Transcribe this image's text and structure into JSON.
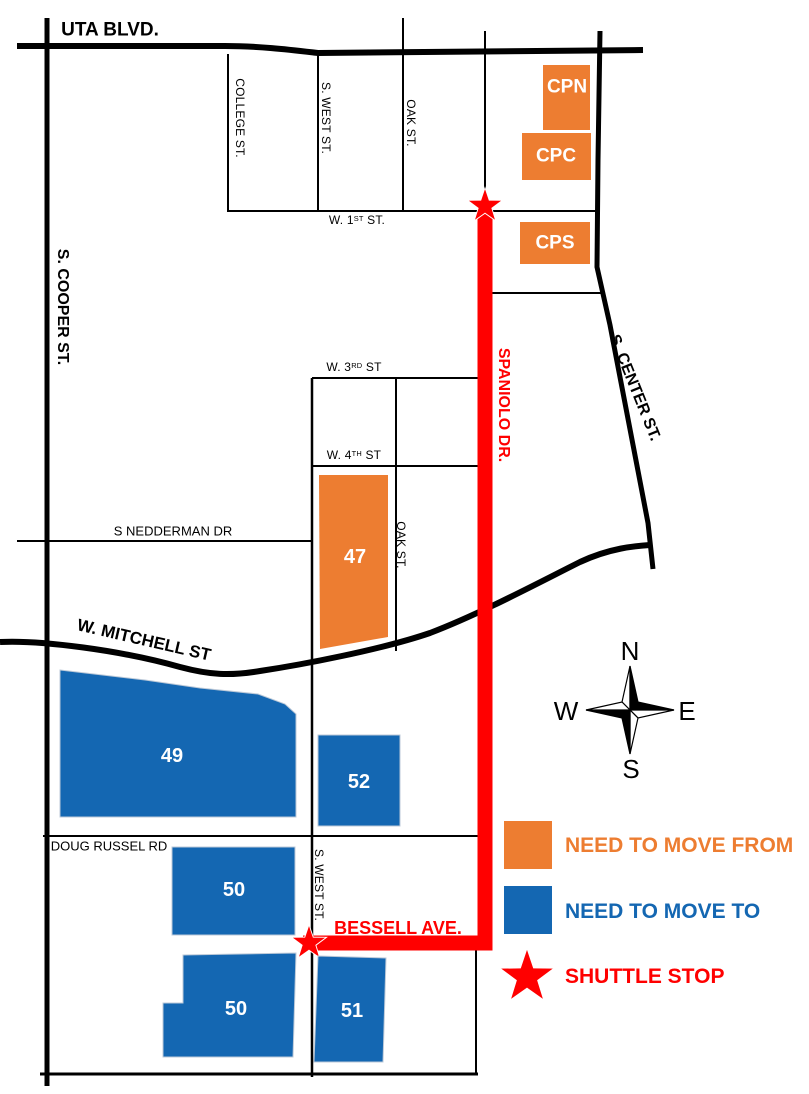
{
  "colors": {
    "orange": "#ED7D31",
    "blue": "#1467B2",
    "red": "#FF0000"
  },
  "streets": {
    "uta": "UTA BLVD.",
    "cooper": "S. COOPER ST.",
    "college": "COLLEGE ST.",
    "west": "S. WEST ST.",
    "oak": "OAK ST.",
    "center": "S. CENTER ST.",
    "w_1st": {
      "base": "W. 1",
      "sup": "ST",
      "rest": " ST."
    },
    "w_3rd": {
      "base": "W. 3",
      "sup": "RD",
      "rest": " ST"
    },
    "w_4th": {
      "base": "W. 4",
      "sup": "TH",
      "rest": " ST"
    },
    "nedderman": "S NEDDERMAN DR",
    "mitchell": "W. MITCHELL ST",
    "doug_russel": "DOUG RUSSEL RD",
    "spaniolo": "SPANIOLO DR.",
    "bessell": "BESSELL AVE."
  },
  "buildings": {
    "cpn": "CPN",
    "cpc": "CPC",
    "cps": "CPS",
    "b47": "47",
    "b49": "49",
    "b52": "52",
    "b50_upper": "50",
    "b50_lower": "50",
    "b51": "51"
  },
  "compass": {
    "n": "N",
    "e": "E",
    "s": "S",
    "w": "W"
  },
  "legend": {
    "move_from": "NEED TO MOVE FROM",
    "move_to": "NEED TO MOVE TO",
    "shuttle_stop": "SHUTTLE STOP"
  }
}
